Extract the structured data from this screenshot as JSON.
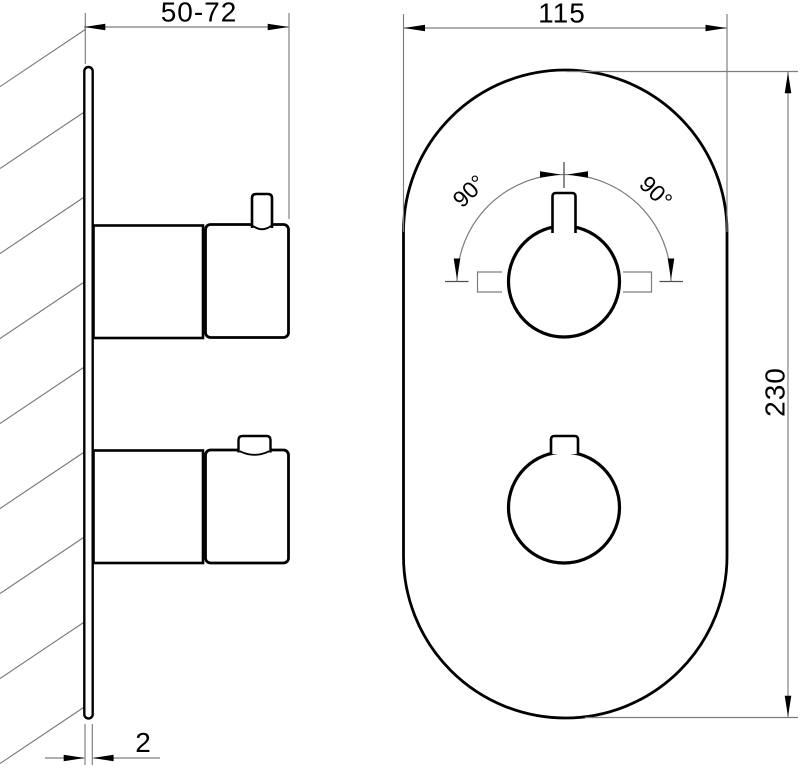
{
  "drawing": {
    "labels": {
      "depth_range": "50-72",
      "faceplate_width": "115",
      "faceplate_height": "230",
      "plate_thickness": "2",
      "angle_left": "90°",
      "angle_right": "90°"
    },
    "colors": {
      "object_line": "#000000",
      "thin_line": "#7d7d7d",
      "background": "#ffffff"
    }
  }
}
